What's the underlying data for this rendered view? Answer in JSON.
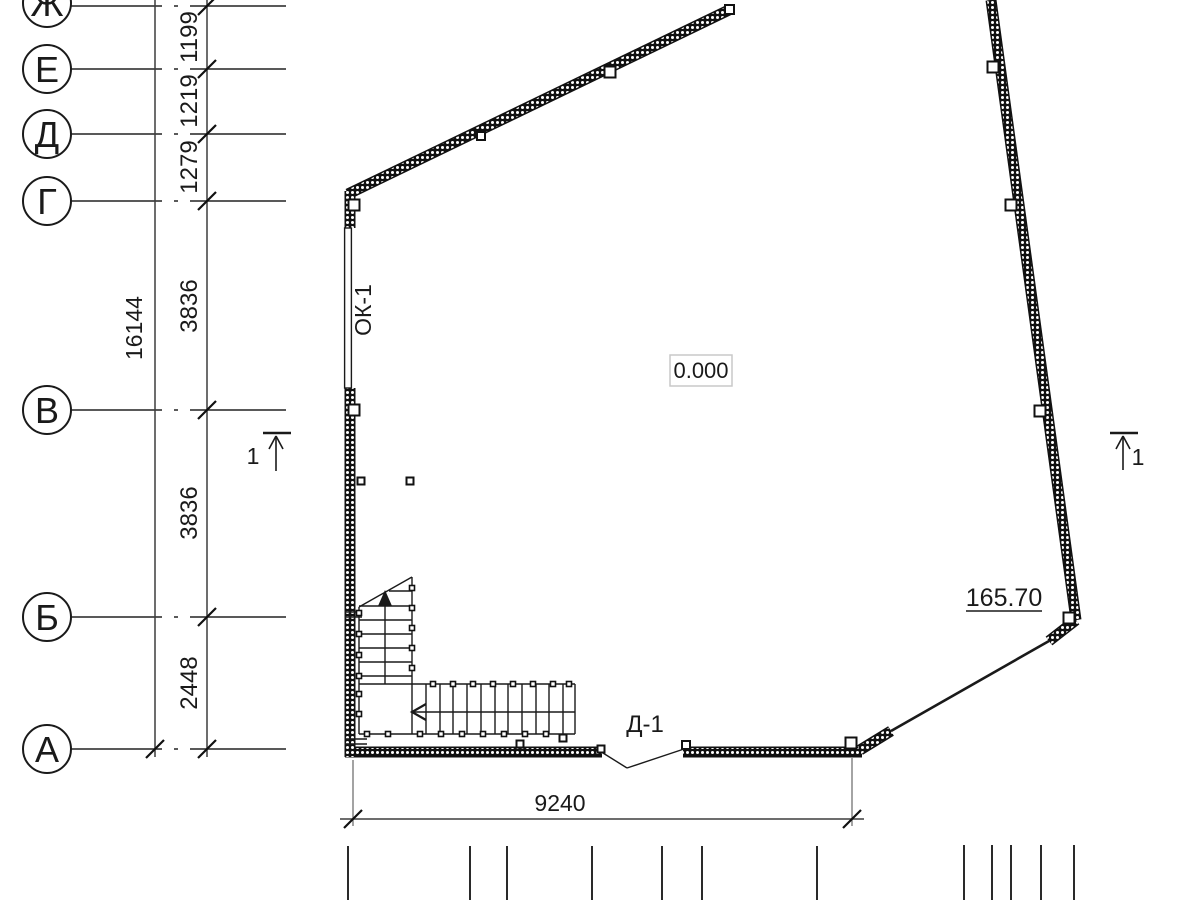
{
  "grid": {
    "rows": [
      {
        "label": "Ж"
      },
      {
        "label": "Е"
      },
      {
        "label": "Д"
      },
      {
        "label": "Г"
      },
      {
        "label": "В"
      },
      {
        "label": "Б"
      },
      {
        "label": "А"
      }
    ],
    "spacing_dims": [
      "1199",
      "1219",
      "1279",
      "3836",
      "3836",
      "2448"
    ],
    "overall_dim": "16144"
  },
  "dimensions": {
    "bottom_width": "9240"
  },
  "marks": {
    "window": "ОК-1",
    "door": "Д-1",
    "elevation_zero": "0.000",
    "elevation_level": "165.70",
    "section_left": "1",
    "section_right": "1"
  },
  "colors": {
    "line": "#1a1a1a",
    "wall": "#111111",
    "dim": "#444444",
    "label_box_border": "#c9c9c9",
    "background": "#ffffff"
  }
}
